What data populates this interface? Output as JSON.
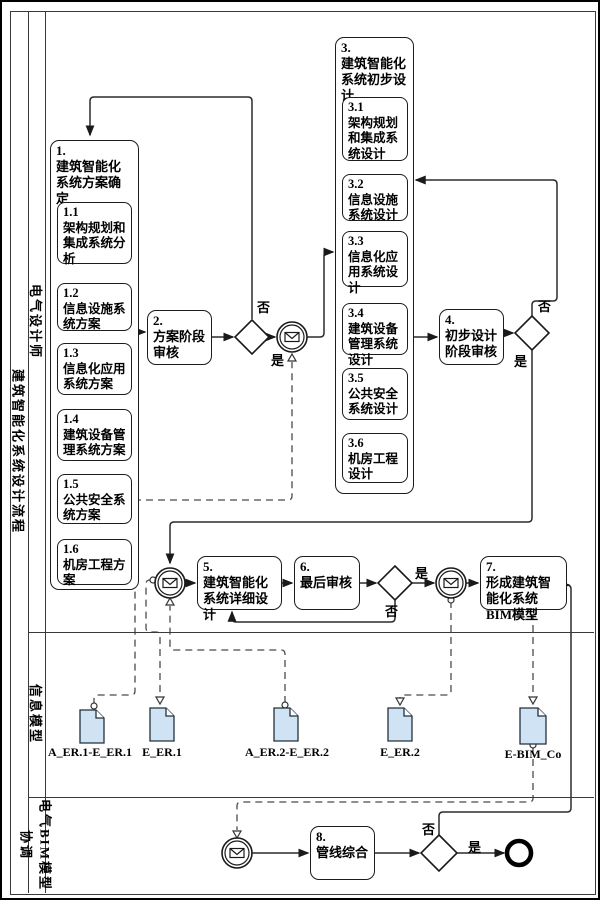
{
  "pool": {
    "title": "建筑智能化系统设计流程"
  },
  "lanes": [
    {
      "label": "电气设计师"
    },
    {
      "label": "信息模型"
    },
    {
      "label": "电气BIM模型协调"
    }
  ],
  "tasks": {
    "t1": {
      "num": "1.",
      "label": "建筑智能化系统方案确定",
      "subs": [
        {
          "num": "1.1",
          "label": "架构规划和集成系统分析"
        },
        {
          "num": "1.2",
          "label": "信息设施系统方案"
        },
        {
          "num": "1.3",
          "label": "信息化应用系统方案"
        },
        {
          "num": "1.4",
          "label": "建筑设备管理系统方案"
        },
        {
          "num": "1.5",
          "label": "公共安全系统方案"
        },
        {
          "num": "1.6",
          "label": "机房工程方案"
        }
      ]
    },
    "t2": {
      "num": "2.",
      "label": "方案阶段审核"
    },
    "t3": {
      "num": "3.",
      "label": "建筑智能化系统初步设计",
      "subs": [
        {
          "num": "3.1",
          "label": "架构规划和集成系统设计"
        },
        {
          "num": "3.2",
          "label": "信息设施系统设计"
        },
        {
          "num": "3.3",
          "label": "信息化应用系统设计"
        },
        {
          "num": "3.4",
          "label": "建筑设备管理系统设计"
        },
        {
          "num": "3.5",
          "label": "公共安全系统设计"
        },
        {
          "num": "3.6",
          "label": "机房工程设计"
        }
      ]
    },
    "t4": {
      "num": "4.",
      "label": "初步设计阶段审核"
    },
    "t5": {
      "num": "5.",
      "label": "建筑智能化系统详细设计"
    },
    "t6": {
      "num": "6.",
      "label": "最后审核"
    },
    "t7": {
      "num": "7.",
      "label": "形成建筑智能化系统BIM模型"
    },
    "t8": {
      "num": "8.",
      "label": "管线综合"
    }
  },
  "gateway_labels": {
    "yes": "是",
    "no": "否"
  },
  "documents": [
    {
      "name": "A_ER.1-E_ER.1"
    },
    {
      "name": "E_ER.1"
    },
    {
      "name": "A_ER.2-E_ER.2"
    },
    {
      "name": "E_ER.2"
    },
    {
      "name": "E-BIM_Co"
    }
  ],
  "colors": {
    "document_fill": "#cfe3f4",
    "line": "#3a3a3a",
    "node_stroke": "#1a1a1a"
  }
}
